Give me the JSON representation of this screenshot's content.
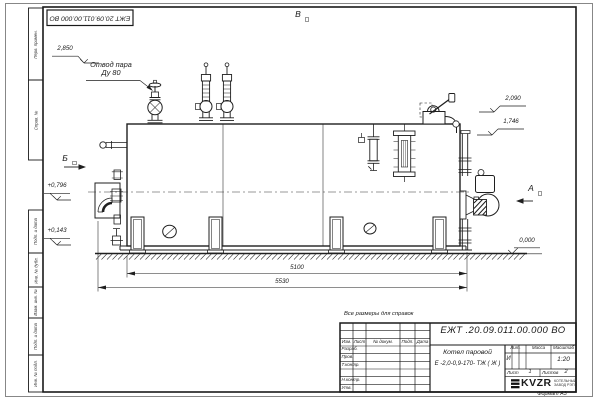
{
  "frame": {
    "doc_number_top": "ЕЖТ 20.09.011.00.000  ВО",
    "format_label": "Формат А3",
    "side_labels": [
      "Перв. примен.",
      "Справ. №",
      "Подп. и дата",
      "Инв. № дубл.",
      "Взам. инв. №",
      "Подп. и дата",
      "Инв. № подл."
    ]
  },
  "views": {
    "a": "А",
    "b": "Б",
    "v": "В"
  },
  "annotations": {
    "steam_outlet_line1": "Отвод пара",
    "steam_outlet_line2": "Ду 80",
    "note": "Все размеры для справок"
  },
  "levels": {
    "l2850": "2,850",
    "l2090": "2,090",
    "l1746": "1,746",
    "l0796": "+0,796",
    "l0143": "+0,143",
    "l0000": "0,000"
  },
  "dimensions": {
    "d5100": "5100",
    "d5530": "5530"
  },
  "title_block": {
    "doc_number": "ЕЖТ .20.09.011.00.000  ВО",
    "product_name_line1": "Котел паровой",
    "product_name_line2": "Е -2,0-0,9-170- ТЖ ( Ж )",
    "col_izm": "Изм.",
    "col_list": "Лист",
    "col_docum": "№ докум.",
    "col_podp": "Подп.",
    "col_data": "Дата",
    "row_razrab": "Разраб.",
    "row_prov": "Пров.",
    "row_tkontr": "Т.контр.",
    "row_nkontr": "Н.контр.",
    "row_utv": "Утв.",
    "lit_header": "Лит.",
    "lit_value": "И",
    "massa_header": "Масса",
    "masshtab_header": "Масштаб",
    "scale": "1:20",
    "sheet_label": "Лист",
    "sheet_value": "1",
    "sheets_label": "Листов",
    "sheets_value": "2",
    "logo_text": "KVZR",
    "logo_sub1": "КОТЕЛЬНЫЙ",
    "logo_sub2": "ЗАВОД РЭП"
  }
}
